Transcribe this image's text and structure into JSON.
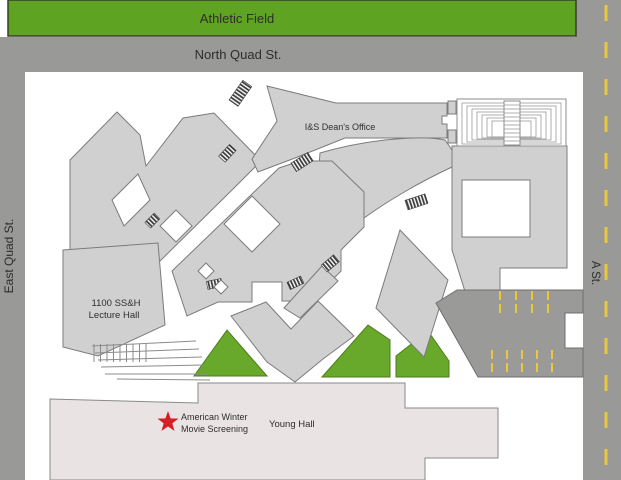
{
  "map": {
    "athletic_field": {
      "label": "Athletic Field"
    },
    "streets": {
      "north": "North Quad St.",
      "east": "East Quad St.",
      "a_street": "A St."
    },
    "buildings": {
      "deans_office": "I&S Dean's Office",
      "lecture_hall_line1": "1100 SS&H",
      "lecture_hall_line2": "Lecture Hall",
      "young_hall": "Young Hall"
    },
    "event_marker": {
      "line1": "American Winter",
      "line2": "Movie Screening"
    },
    "colors": {
      "field_green": "#5ea321",
      "lawn_green": "#68a82b",
      "road_gray": "#999998",
      "parking_gray": "#9a9a99",
      "building_gray": "#d1d0d0",
      "building_outline": "#7c7b7b",
      "young_hall_fill": "#e9e4e3",
      "dash_yellow": "#e9c83f",
      "marker_red": "#d41f26",
      "label_ink": "#2e2d2c"
    }
  }
}
